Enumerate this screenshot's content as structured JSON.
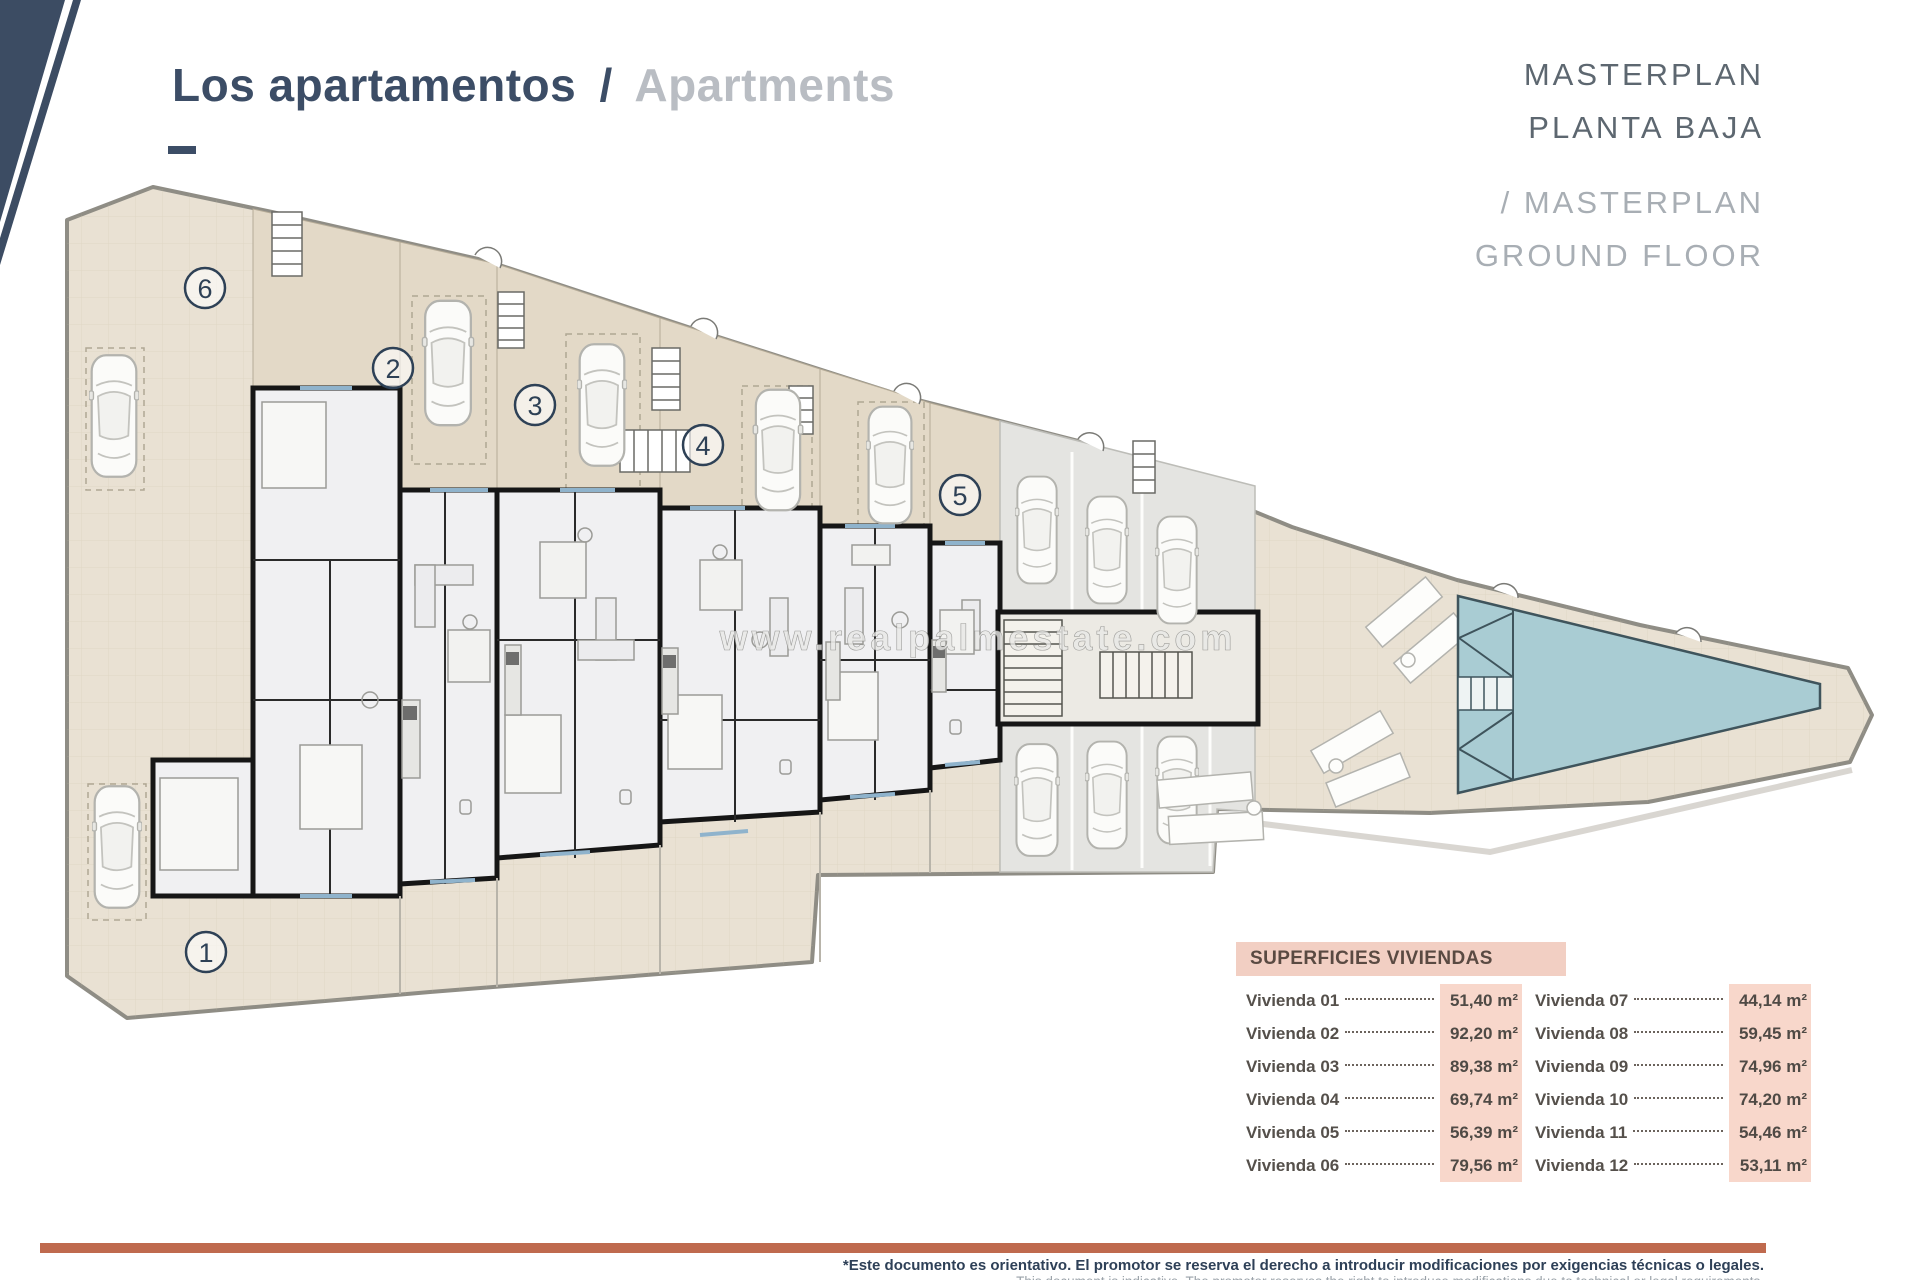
{
  "header": {
    "title_primary": "Los apartamentos",
    "title_divider": "/",
    "title_secondary": "Apartments"
  },
  "masterplan_label": {
    "line1": "MASTERPLAN",
    "line2": "PLANTA BAJA",
    "line3": "/ MASTERPLAN",
    "line4": "GROUND FLOOR"
  },
  "plan": {
    "watermark": "www.realpalmestate.com",
    "unit_labels": {
      "u1": "1",
      "u2": "2",
      "u3": "3",
      "u4": "4",
      "u5": "5",
      "u6": "6"
    }
  },
  "areas_table": {
    "title": "SUPERFICIES VIVIENDAS",
    "left_column": [
      {
        "label": "Vivienda 01",
        "value": "51,40 m²"
      },
      {
        "label": "Vivienda 02",
        "value": "92,20 m²"
      },
      {
        "label": "Vivienda 03",
        "value": "89,38 m²"
      },
      {
        "label": "Vivienda 04",
        "value": "69,74 m²"
      },
      {
        "label": "Vivienda 05",
        "value": "56,39 m²"
      },
      {
        "label": "Vivienda 06",
        "value": "79,56 m²"
      }
    ],
    "right_column": [
      {
        "label": "Vivienda 07",
        "value": "44,14 m²"
      },
      {
        "label": "Vivienda 08",
        "value": "59,45 m²"
      },
      {
        "label": "Vivienda 09",
        "value": "74,96 m²"
      },
      {
        "label": "Vivienda 10",
        "value": "74,20 m²"
      },
      {
        "label": "Vivienda 11",
        "value": "54,46 m²"
      },
      {
        "label": "Vivienda 12",
        "value": "53,11 m²"
      }
    ]
  },
  "footer": {
    "disclaimer_primary": "*Este documento es orientativo. El promotor se reserva el derecho a introducir modificaciones por exigencias técnicas o legales.",
    "disclaimer_secondary": "This document is indicative. The promoter reserves the right to introduce modifications due to technical or legal requirements."
  },
  "colors": {
    "accent_navy": "#3c4c63",
    "accent_orange": "#bf6a4e",
    "pool": "#a9ccd3",
    "plan_beige": "#e9e1d3",
    "table_highlight": "#f8d7cb"
  }
}
